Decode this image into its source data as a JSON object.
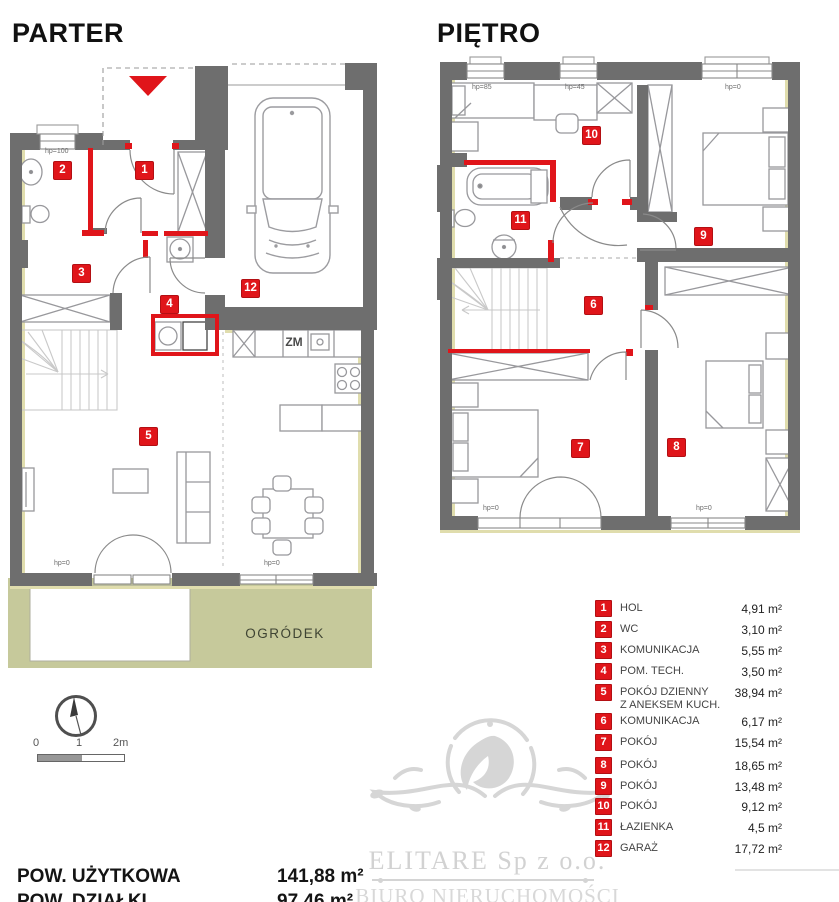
{
  "titles": {
    "parter": "PARTER",
    "pietro": "PIĘTRO"
  },
  "plans": {
    "parter": {
      "markers": [
        {
          "num": "1"
        },
        {
          "num": "2"
        },
        {
          "num": "3"
        },
        {
          "num": "4"
        },
        {
          "num": "5"
        },
        {
          "num": "12"
        }
      ],
      "hp": [
        {
          "text": "hp=100"
        },
        {
          "text": "hp=0"
        },
        {
          "text": "hp=0"
        }
      ],
      "zm": "ZM",
      "ogrodek": "OGRÓDEK"
    },
    "pietro": {
      "markers": [
        {
          "num": "6"
        },
        {
          "num": "7"
        },
        {
          "num": "8"
        },
        {
          "num": "9"
        },
        {
          "num": "10"
        },
        {
          "num": "11"
        }
      ],
      "hp": [
        {
          "text": "hp=85"
        },
        {
          "text": "hp=45"
        },
        {
          "text": "hp=0"
        },
        {
          "text": "hp=0"
        },
        {
          "text": "hp=0"
        }
      ]
    }
  },
  "legend": {
    "items": [
      {
        "num": "1",
        "label": "HOL",
        "label2": "",
        "area": "4,91 m²"
      },
      {
        "num": "2",
        "label": "WC",
        "label2": "",
        "area": "3,10 m²"
      },
      {
        "num": "3",
        "label": "KOMUNIKACJA",
        "label2": "",
        "area": "5,55 m²"
      },
      {
        "num": "4",
        "label": "POM. TECH.",
        "label2": "",
        "area": "3,50 m²"
      },
      {
        "num": "5",
        "label": "POKÓJ DZIENNY",
        "label2": "Z ANEKSEM KUCH.",
        "area": "38,94 m²"
      },
      {
        "num": "6",
        "label": "KOMUNIKACJA",
        "label2": "",
        "area": "6,17 m²"
      },
      {
        "num": "7",
        "label": "POKÓJ",
        "label2": "",
        "area": "15,54 m²"
      },
      {
        "num": "8",
        "label": "POKÓJ",
        "label2": "",
        "area": "18,65 m²"
      },
      {
        "num": "9",
        "label": "POKÓJ",
        "label2": "",
        "area": "13,48 m²"
      },
      {
        "num": "10",
        "label": "POKÓJ",
        "label2": "",
        "area": "9,12 m²"
      },
      {
        "num": "11",
        "label": "ŁAZIENKA",
        "label2": "",
        "area": "4,5 m²"
      },
      {
        "num": "12",
        "label": "GARAŻ",
        "label2": "",
        "area": "17,72 m²"
      }
    ]
  },
  "scale": {
    "t0": "0",
    "t1": "1",
    "t2": "2m"
  },
  "summary": {
    "rows": [
      {
        "label": "POW. UŻYTKOWA",
        "value": "141,88 m²"
      },
      {
        "label": "POW. DZIAŁKI",
        "value": "97,46 m²"
      }
    ]
  },
  "watermark": {
    "line1": "ELITARE Sp z o.o.",
    "line2": "BIURO NIERUCHOMOŚCI"
  },
  "colors": {
    "red": "#e0151a",
    "wall": "#6e6e6e",
    "garden": "#c6c99b",
    "watermark": "#d4d4d4",
    "insulation": "#e0ddad"
  }
}
